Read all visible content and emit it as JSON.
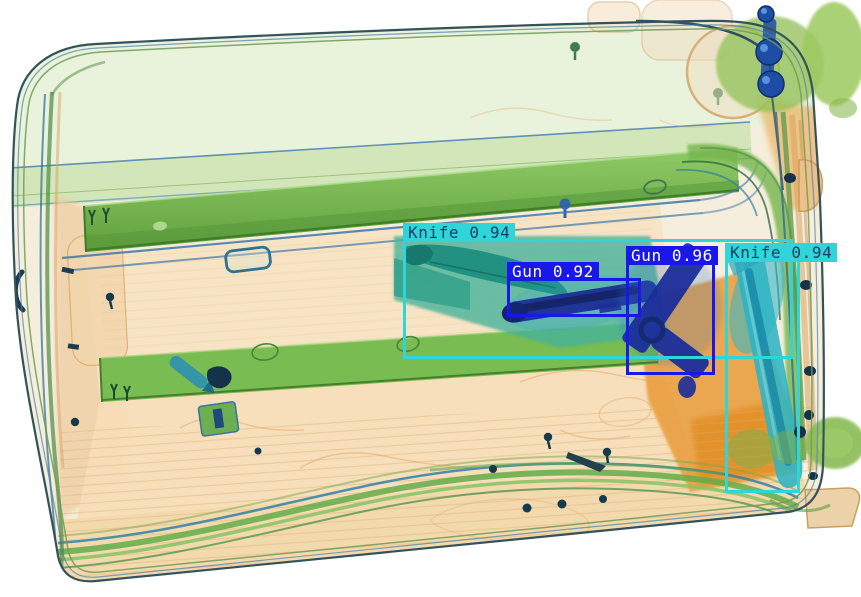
{
  "scene": {
    "canvas": {
      "width": 861,
      "height": 597,
      "background": "#ffffff"
    }
  },
  "detections": [
    {
      "label": "Knife",
      "score": "0.94",
      "display": "Knife 0.94",
      "bbox": {
        "x": 403,
        "y": 239,
        "w": 390,
        "h": 120
      },
      "box_color": "#30d5da",
      "label_bg": "#30d5da",
      "text_color": "#0d3f63"
    },
    {
      "label": "Gun",
      "score": "0.92",
      "display": "Gun 0.92",
      "bbox": {
        "x": 507,
        "y": 278,
        "w": 134,
        "h": 39
      },
      "box_color": "#1a17ea",
      "label_bg": "#1a17ea",
      "text_color": "#ffffff"
    },
    {
      "label": "Gun",
      "score": "0.96",
      "display": "Gun 0.96",
      "bbox": {
        "x": 626,
        "y": 262,
        "w": 89,
        "h": 113
      },
      "box_color": "#1a17ea",
      "label_bg": "#1a17ea",
      "text_color": "#ffffff"
    },
    {
      "label": "Knife",
      "score": "0.94",
      "display": "Knife 0.94",
      "bbox": {
        "x": 725,
        "y": 259,
        "w": 75,
        "h": 234
      },
      "box_color": "#30d5da",
      "label_bg": "#30d5da",
      "text_color": "#0d3f63"
    }
  ],
  "palette": {
    "knife_box": "#30d5da",
    "gun_box": "#1a17ea",
    "organic_orange": "#e9962f",
    "metal_blue": "#1b2d9b",
    "frame_green": "#72b84e"
  }
}
